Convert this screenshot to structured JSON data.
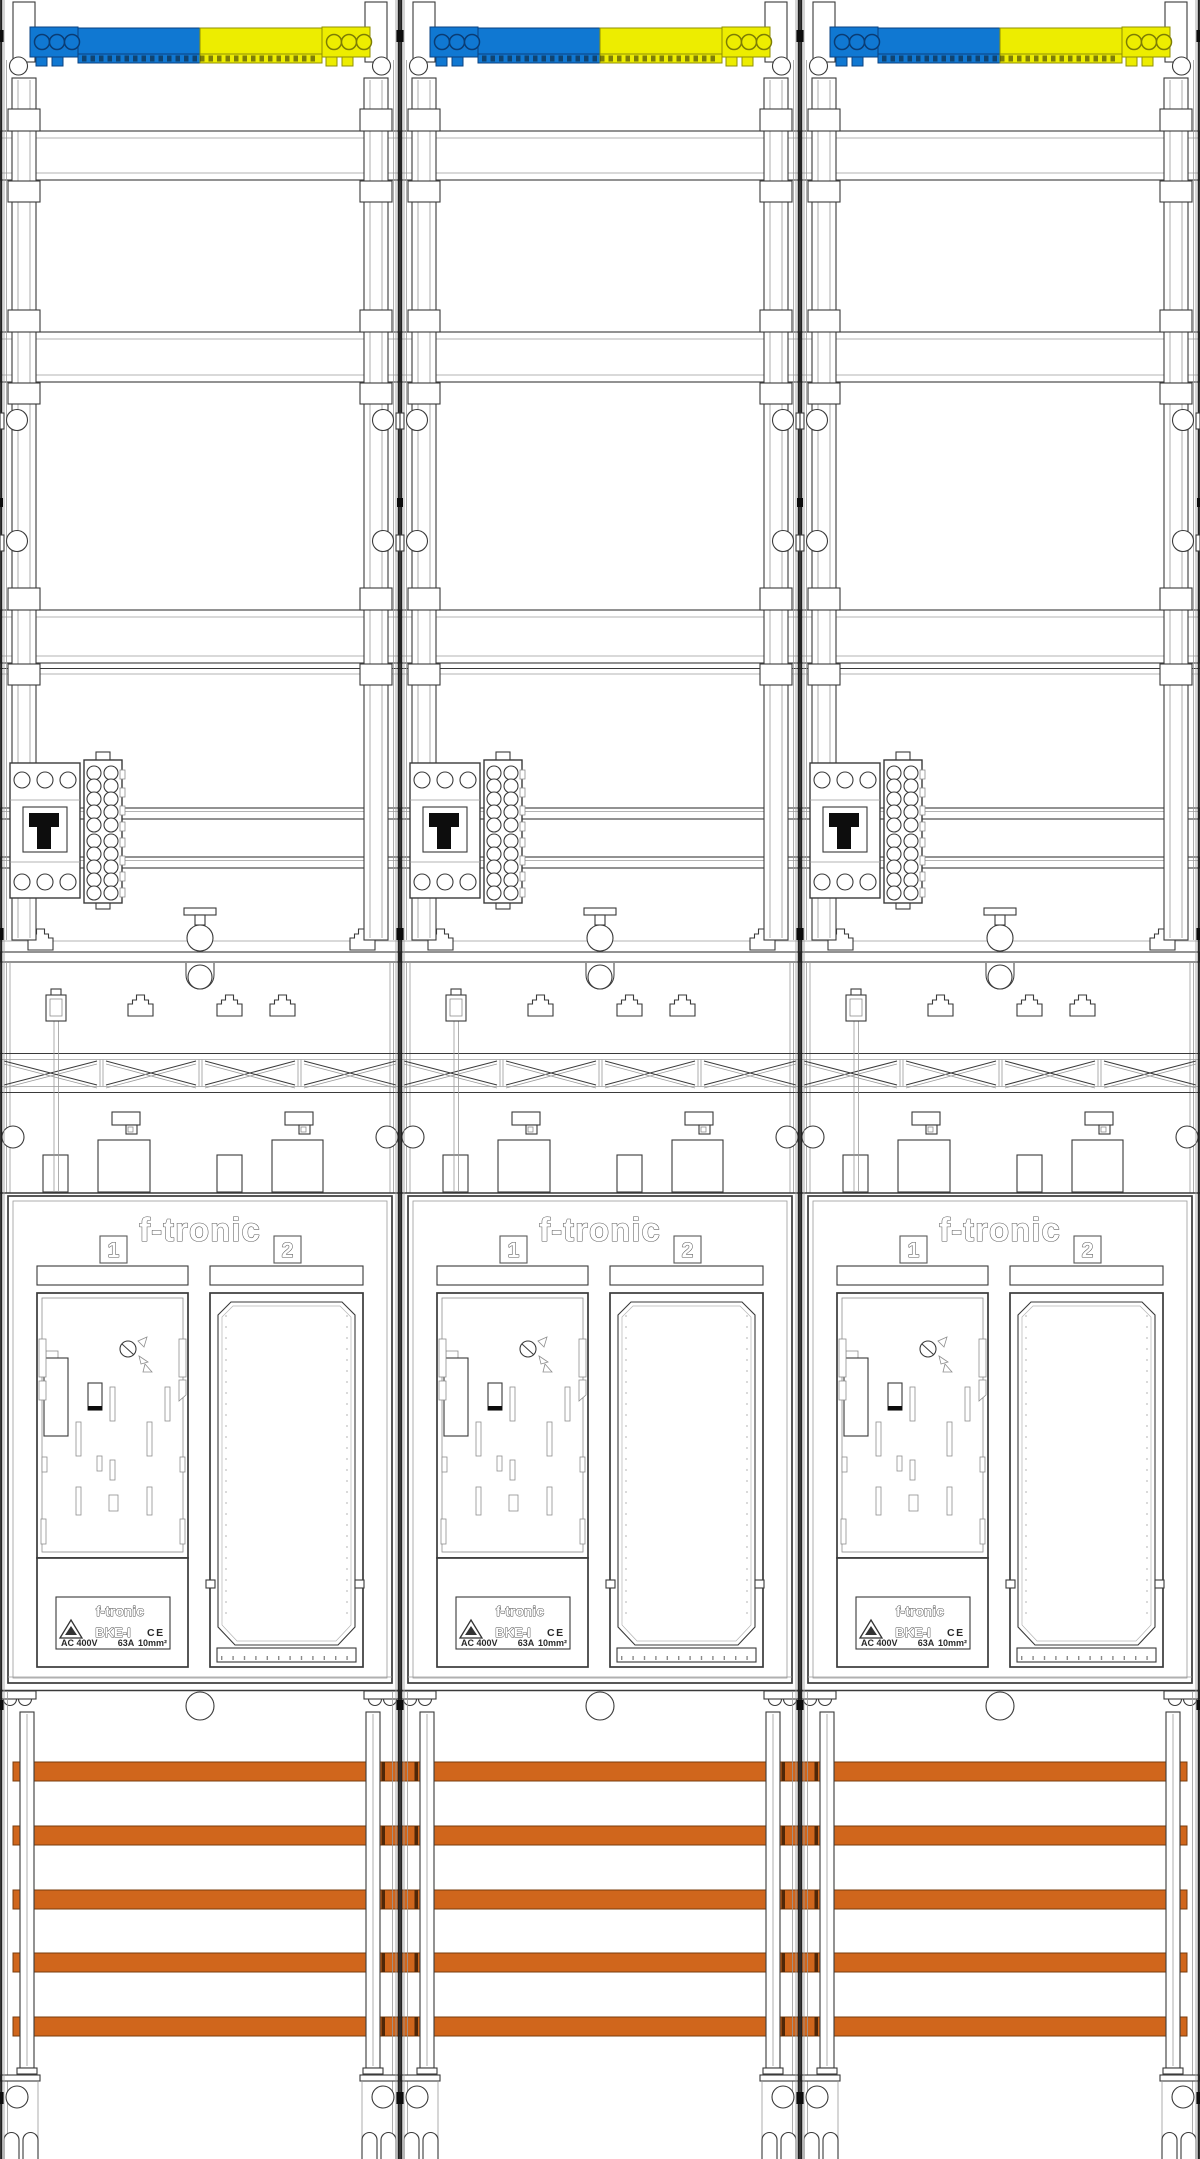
{
  "drawing": {
    "brand_logo": "f-tronic",
    "meter_field_left_number": "1",
    "meter_field_right_number": "2",
    "type_label": {
      "brand": "f-tronic",
      "model": "BKE-I",
      "certification": "CE",
      "rating_voltage": "AC 400V",
      "rating_current": "63A",
      "rating_wire_size": "10mm²"
    },
    "colors": {
      "terminal_blue": "#1078d2",
      "terminal_yellow": "#eded00",
      "busbar_orange": "#d0661c"
    }
  }
}
